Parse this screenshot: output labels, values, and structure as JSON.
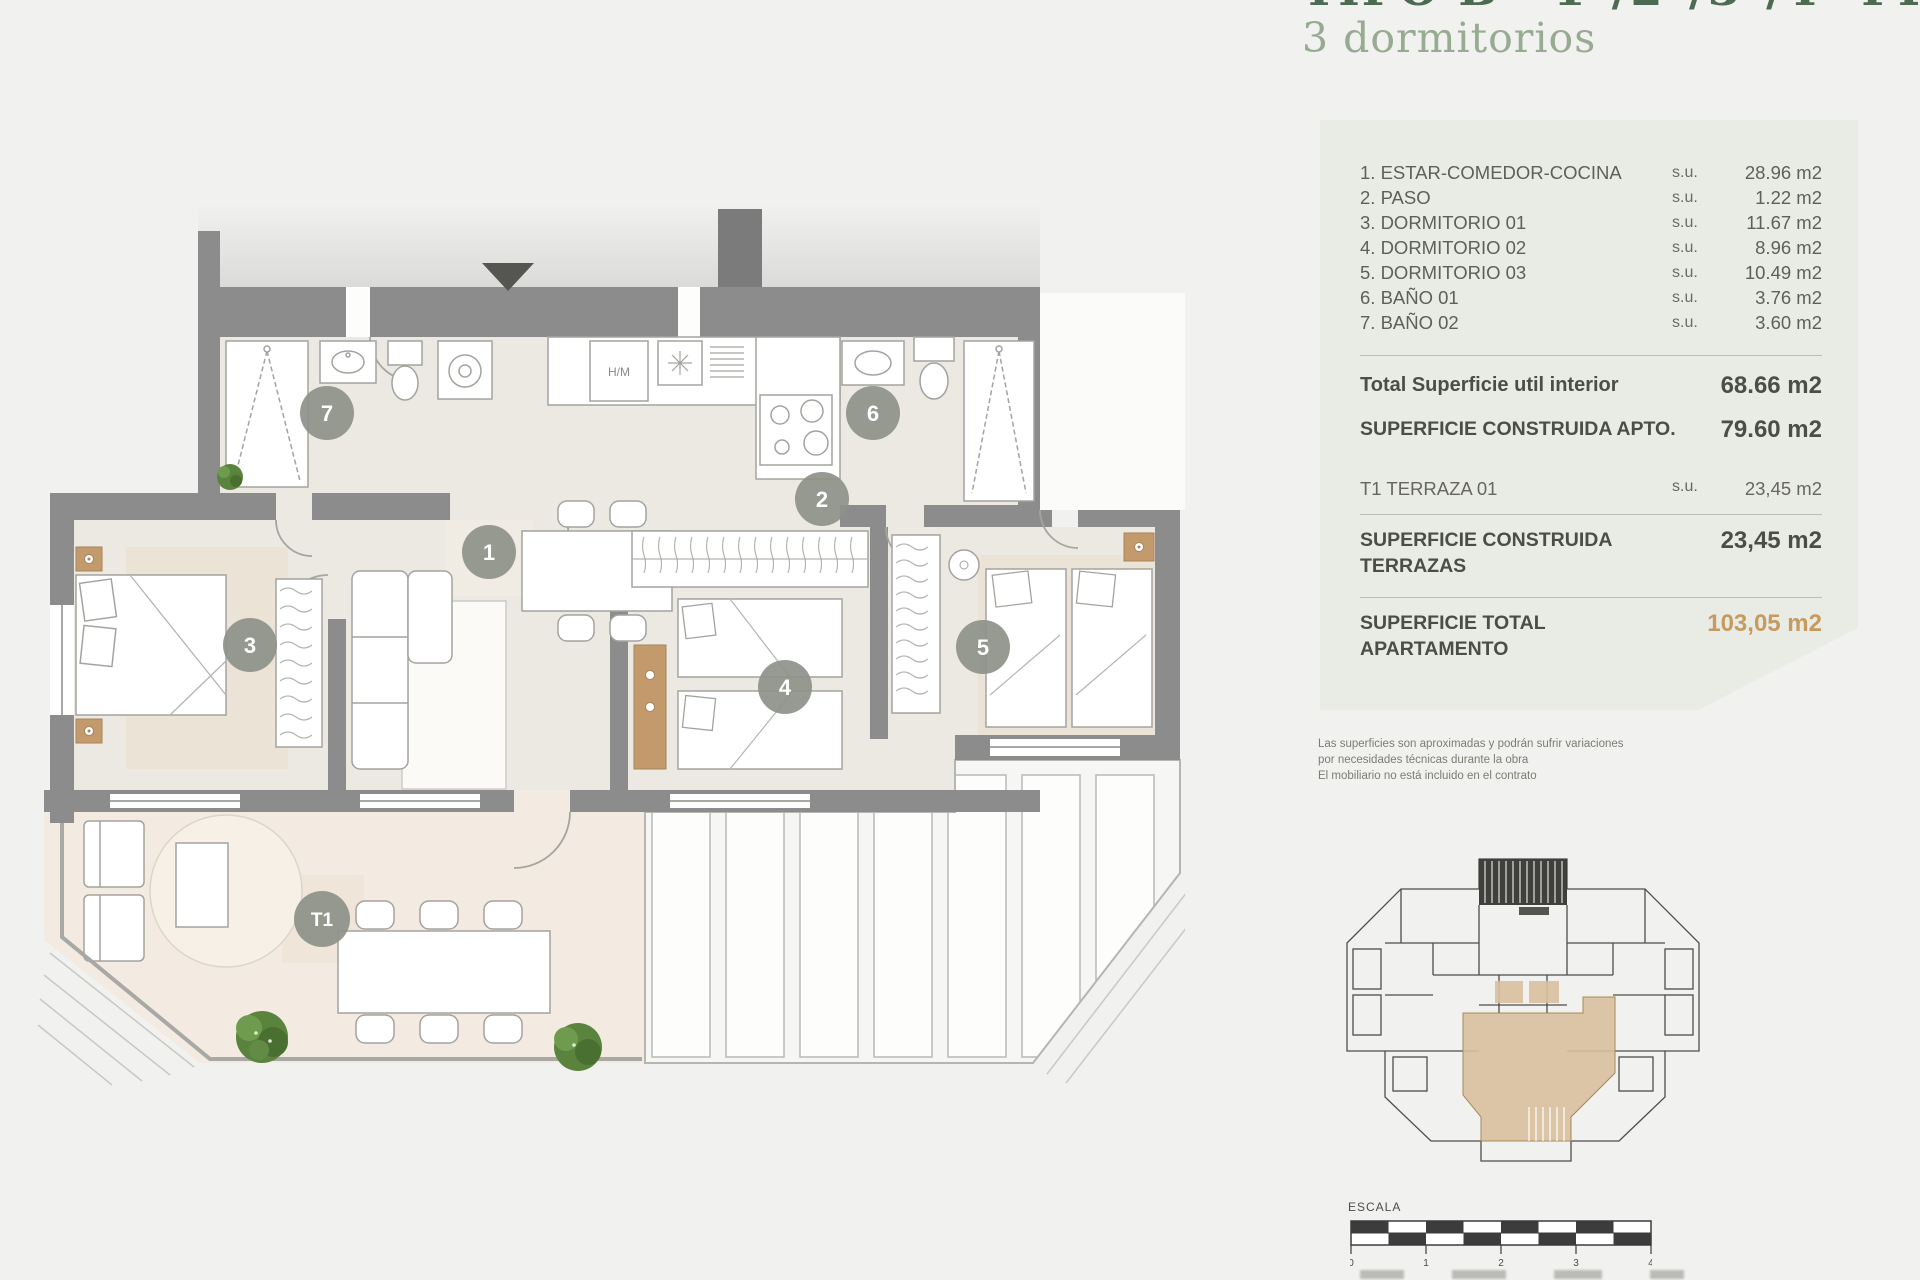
{
  "page": {
    "bg": "#f1f1ef"
  },
  "header": {
    "title_clipped": "TIPO B · 1ª/2ª/3ª/4ª PLANTA",
    "subtitle": "3 dormitorios"
  },
  "panel": {
    "rooms": [
      {
        "name": "1. ESTAR-COMEDOR-COCINA",
        "prefix": "s.u.",
        "value": "28.96 m2"
      },
      {
        "name": "2. PASO",
        "prefix": "s.u.",
        "value": "1.22 m2"
      },
      {
        "name": "3. DORMITORIO 01",
        "prefix": "s.u.",
        "value": "11.67 m2"
      },
      {
        "name": "4. DORMITORIO 02",
        "prefix": "s.u.",
        "value": "8.96 m2"
      },
      {
        "name": "5. DORMITORIO 03",
        "prefix": "s.u.",
        "value": "10.49 m2"
      },
      {
        "name": "6. BAÑO 01",
        "prefix": "s.u.",
        "value": "3.76 m2"
      },
      {
        "name": "7. BAÑO 02",
        "prefix": "s.u.",
        "value": "3.60 m2"
      }
    ],
    "total_util_label": "Total Superficie util interior",
    "total_util_value": "68.66 m2",
    "construida_apto_label": "SUPERFICIE CONSTRUIDA APTO.",
    "construida_apto_value": "79.60 m2",
    "terraza_label": "T1 TERRAZA 01",
    "terraza_prefix": "s.u.",
    "terraza_value": "23,45 m2",
    "construida_terrazas_label_1": "SUPERFICIE CONSTRUIDA",
    "construida_terrazas_label_2": "TERRAZAS",
    "construida_terrazas_value": "23,45 m2",
    "total_apartamento_label_1": "SUPERFICIE TOTAL",
    "total_apartamento_label_2": "APARTAMENTO",
    "total_apartamento_value": "103,05 m2"
  },
  "disclaimer": {
    "line1": "Las superficies son aproximadas y podrán sufrir variaciones",
    "line2": "por necesidades técnicas durante la obra",
    "line3": "El mobiliario no está incluido en el contrato",
    "line4": ""
  },
  "plan": {
    "badge_1": "1",
    "badge_2": "2",
    "badge_3": "3",
    "badge_4": "4",
    "badge_5": "5",
    "badge_6": "6",
    "badge_7": "7",
    "badge_t1": "T1",
    "kitchen_appliance_label": "H/M"
  },
  "scale_bar": {
    "label": "ESCALA",
    "tick_0": "0",
    "tick_1": "1",
    "tick_2": "2",
    "tick_3": "3",
    "tick_4": "4"
  },
  "colors": {
    "accent_total": "#c79a5f",
    "panel_bg": "#e9ece5",
    "wall": "#8c8c8c",
    "badge": "#8d9189",
    "title_green": "#96ab91",
    "title_dark": "#4c6b52",
    "highlight_unit": "#d9c09e",
    "terrace_floor": "#f3eae1",
    "interior_floor": "#ece8e2"
  }
}
